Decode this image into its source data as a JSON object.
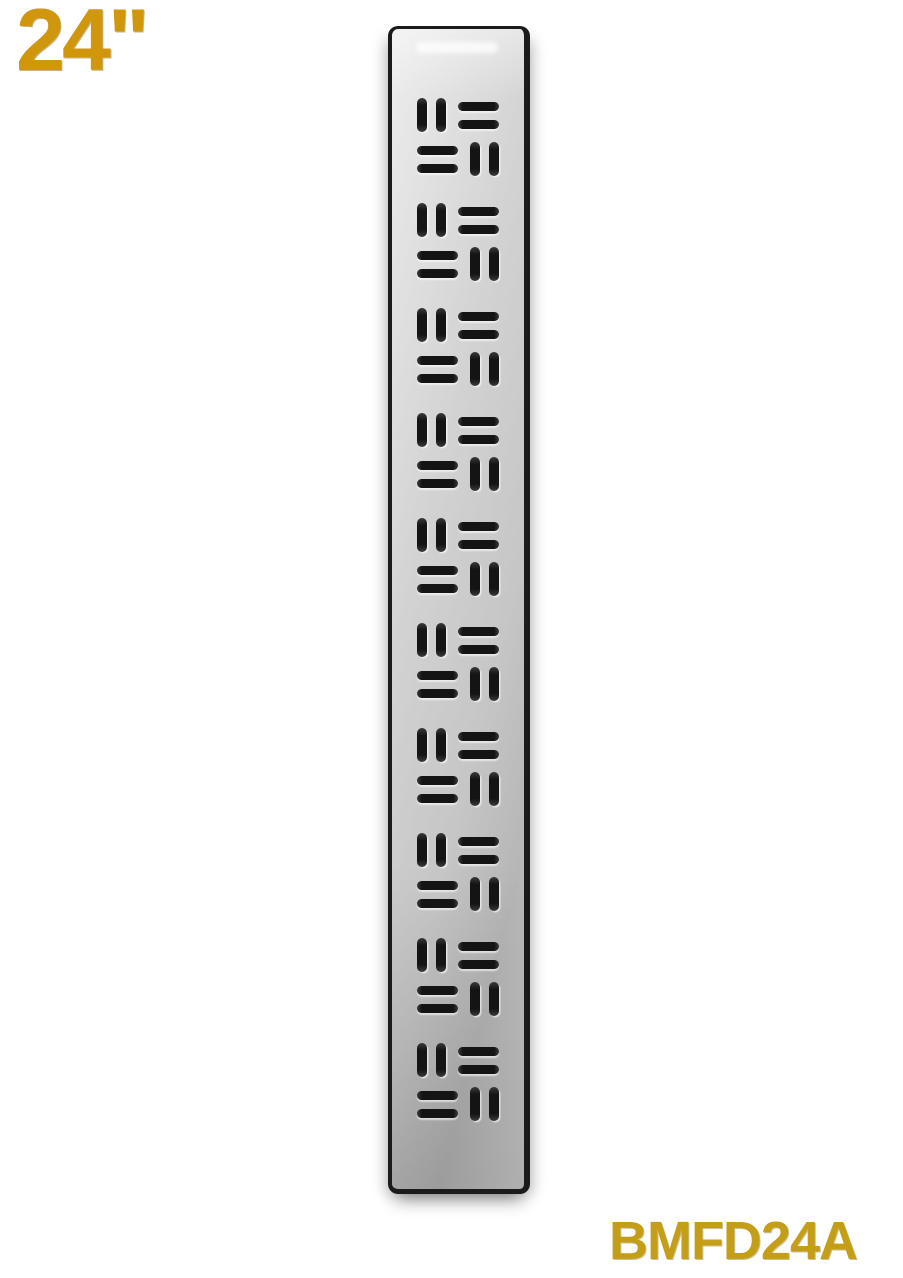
{
  "labels": {
    "size_label": "24\"",
    "model_number": "BMFD24A"
  },
  "product": {
    "type": "linear shower drain grate",
    "pattern_style": "basketweave slots",
    "grate": {
      "group_count": 10,
      "rows_per_group": 2,
      "slots_per_cell": 2
    }
  },
  "theme": {
    "bg": "#ffffff",
    "gold-size": "#D0960C",
    "gold-model": "#C59E17",
    "frame": "#1b1b1b",
    "slot": "#141414",
    "surface-light": "#ededed",
    "surface-mid": "#d2d2d2",
    "surface-dark": "#b6b6b6"
  }
}
